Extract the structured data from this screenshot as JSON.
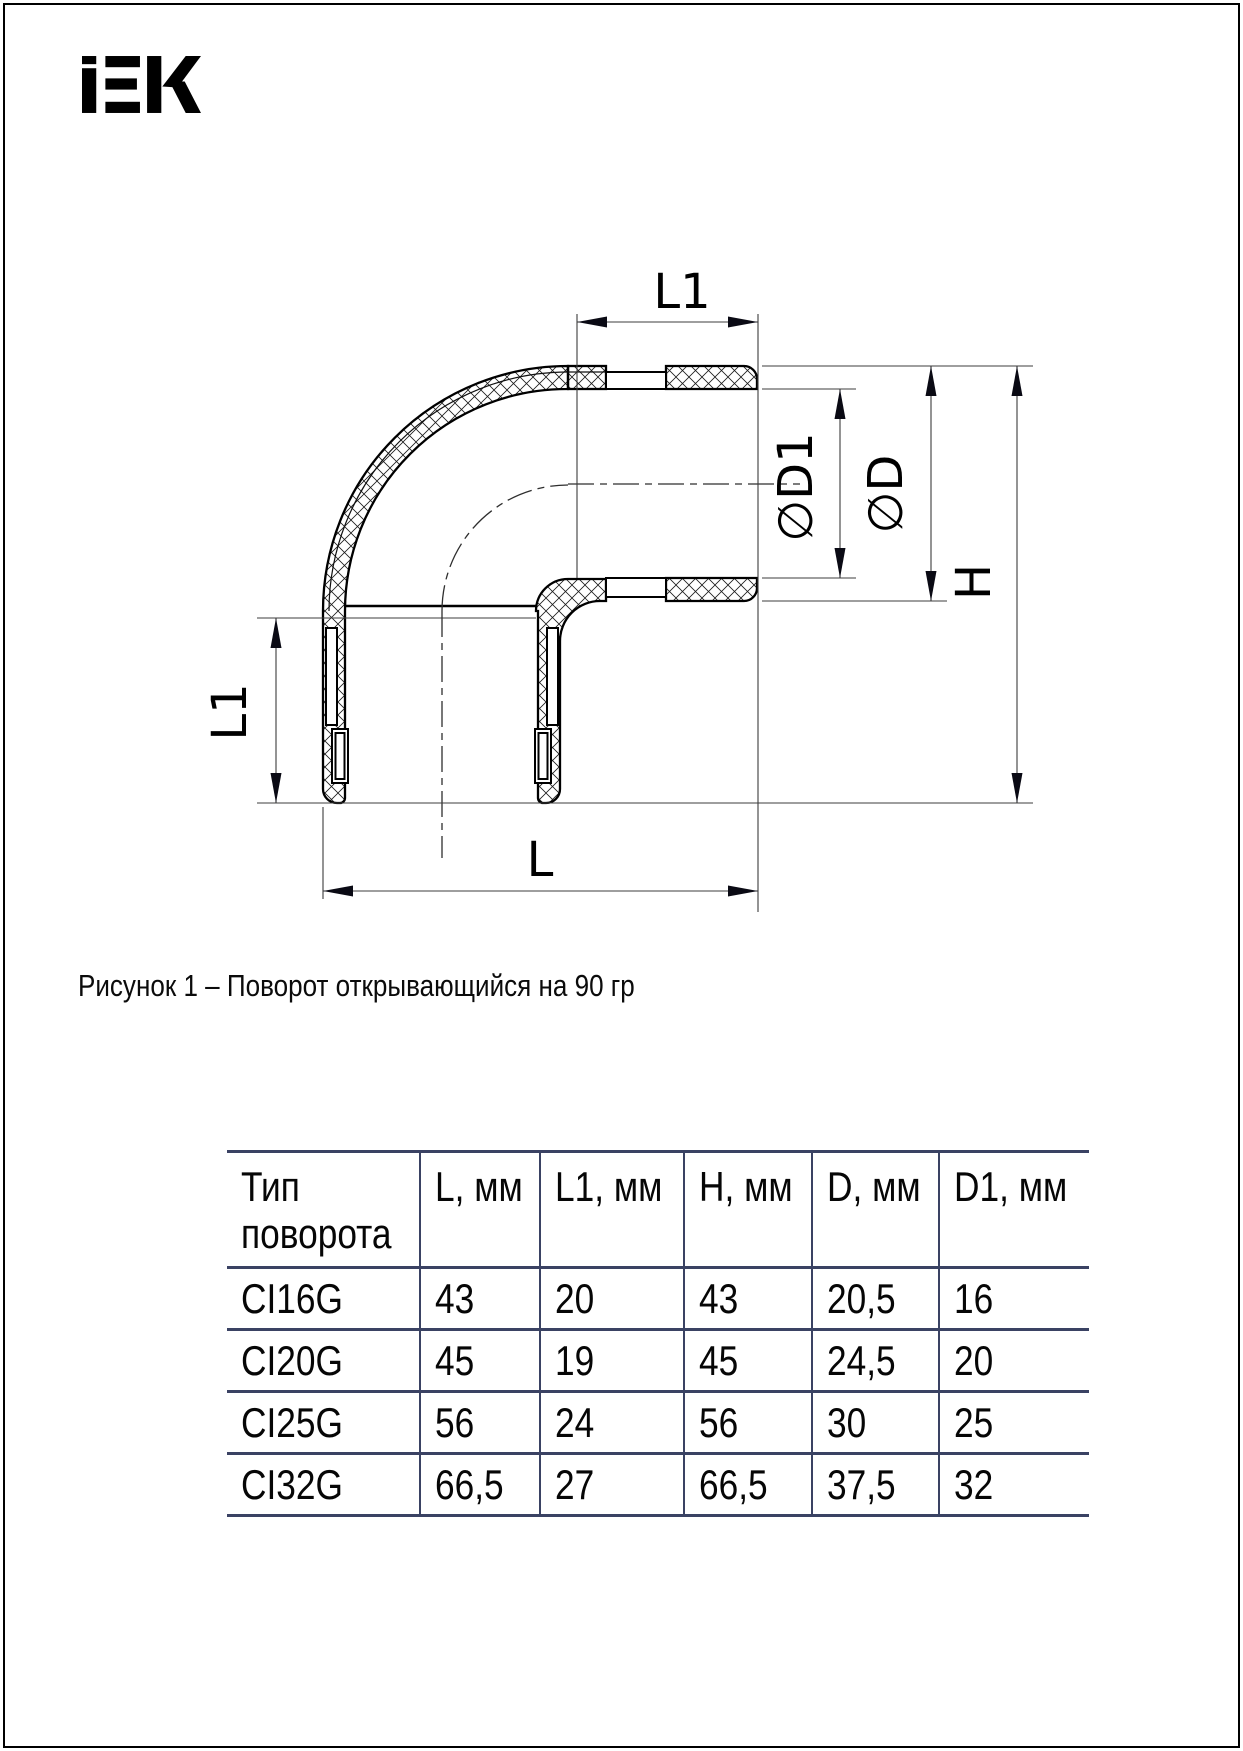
{
  "logo": {
    "text": "IEK",
    "color": "#000000"
  },
  "figure": {
    "caption": "Рисунок 1 – Поворот открывающийся на 90 гр",
    "dimension_labels": {
      "l1_top": "L1",
      "l1_left": "L1",
      "l_bottom": "L",
      "d1": "∅D1",
      "d": "∅D",
      "h": "H"
    }
  },
  "table": {
    "border_color": "#3a4263",
    "headers": [
      "Тип поворота",
      "L, мм",
      "L1, мм",
      "H, мм",
      "D, мм",
      "D1, мм"
    ],
    "rows": [
      [
        "CI16G",
        "43",
        "20",
        "43",
        "20,5",
        "16"
      ],
      [
        "CI20G",
        "45",
        "19",
        "45",
        "24,5",
        "20"
      ],
      [
        "CI25G",
        "56",
        "24",
        "56",
        "30",
        "25"
      ],
      [
        "CI32G",
        "66,5",
        "27",
        "66,5",
        "37,5",
        "32"
      ]
    ]
  }
}
